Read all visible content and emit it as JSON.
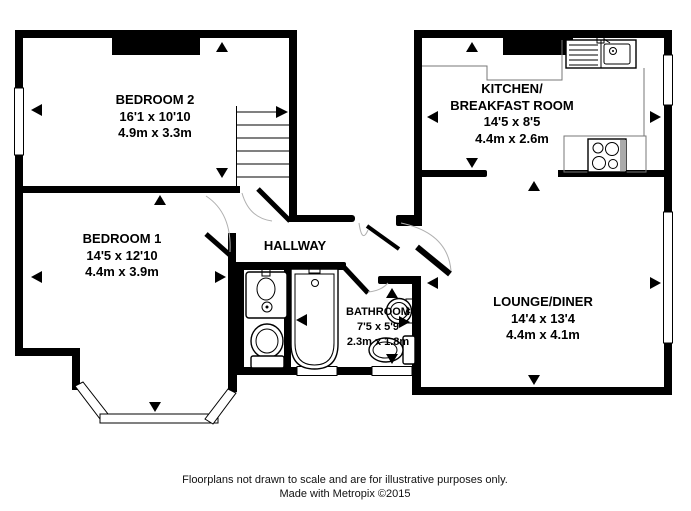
{
  "rooms": {
    "bedroom2": {
      "name": "BEDROOM 2",
      "imperial": "16'1 x 10'10",
      "metric": "4.9m x 3.3m"
    },
    "bedroom1": {
      "name": "BEDROOM 1",
      "imperial": "14'5 x 12'10",
      "metric": "4.4m x 3.9m"
    },
    "hallway": {
      "name": "HALLWAY"
    },
    "bathroom": {
      "name": "BATHROOM",
      "imperial": "7'5 x 5'9",
      "metric": "2.3m x 1.8m"
    },
    "kitchen": {
      "name_line1": "KITCHEN/",
      "name_line2": "BREAKFAST ROOM",
      "imperial": "14'5 x 8'5",
      "metric": "4.4m x 2.6m"
    },
    "lounge": {
      "name": "LOUNGE/DINER",
      "imperial": "14'4 x 13'4",
      "metric": "4.4m x 4.1m"
    }
  },
  "fixtures": {
    "stairs": "staircase with direction arrow",
    "kitchen_sink": "sink and drainer unit",
    "hob": "four ring hob on counter",
    "bath": "bath tub",
    "bathroom_basin": "round wash basin",
    "bathroom_wc": "toilet",
    "cloak_basin": "vanity wash basin",
    "cloak_wc": "toilet",
    "bay_window": "bay window",
    "chimney_breasts": "chimney breast blocks"
  },
  "colors": {
    "wall": "#000000",
    "background": "#ffffff",
    "door_arc": "#b0b0b0"
  },
  "footer": {
    "line1": "Floorplans not drawn to scale and are for illustrative purposes only.",
    "line2": "Made with Metropix ©2015"
  }
}
